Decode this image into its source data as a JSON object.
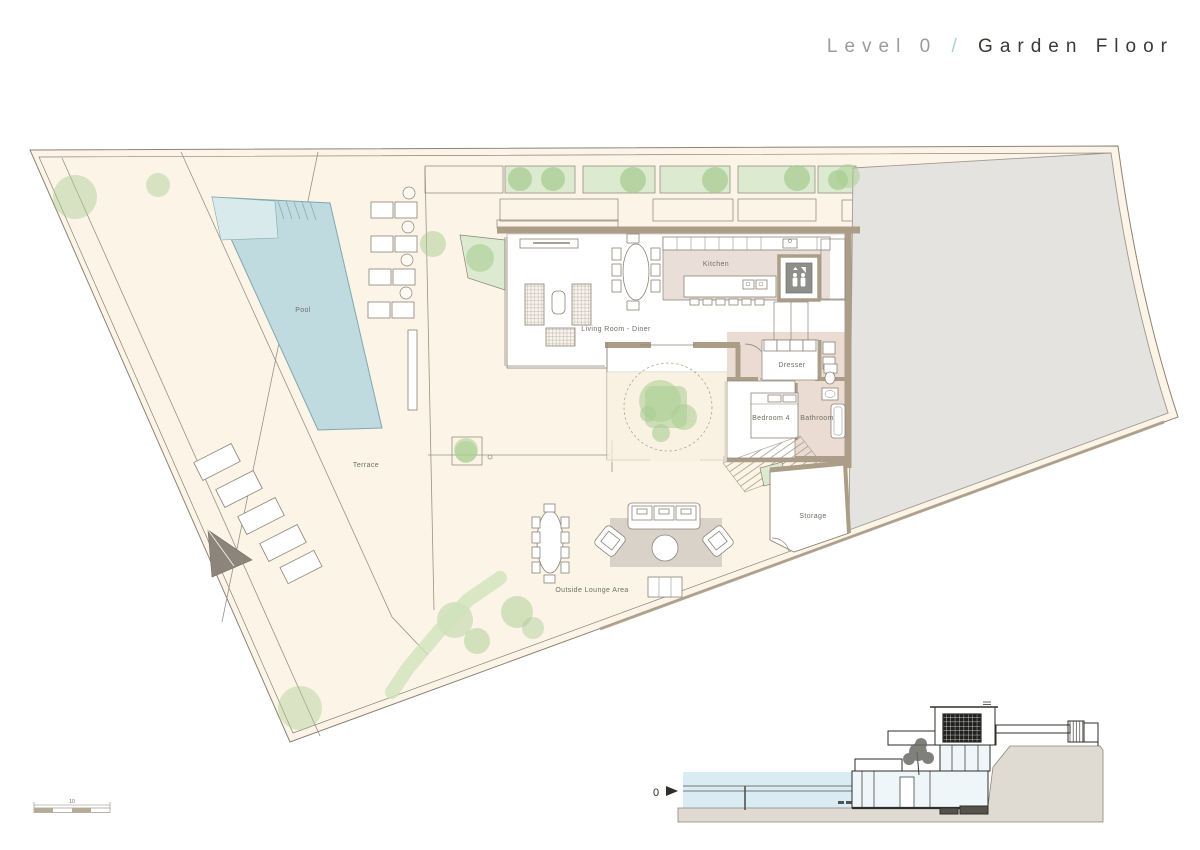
{
  "title": {
    "level": "Level 0",
    "separator": "/",
    "name": "Garden Floor"
  },
  "labels": {
    "pool": "Pool",
    "terrace": "Terrace",
    "living_room": "Living Room - Diner",
    "kitchen": "Kitchen",
    "dresser": "Dresser",
    "bedroom": "Bedroom 4",
    "bathroom": "Bathroom",
    "storage": "Storage",
    "outside_lounge": "Outside Lounge Area"
  },
  "section": {
    "level_marker": "0"
  },
  "scale_bar": {
    "label": "10"
  },
  "icons": {
    "elevator": "elevator-people-icon",
    "section_marker": "level-arrow-icon"
  },
  "colors": {
    "site_fill": "#fbf4e7",
    "terrace_fill": "#f8efe0",
    "wall": "#ac9d89",
    "wall_line": "#8d8378",
    "pool_water": "#c0dbdf",
    "pool_shallow": "#d9eaec",
    "neighbor_gray": "#e4e3e0",
    "planter_green": "#dcead0",
    "tree_green": "#a9cd92",
    "room_white": "#ffffff",
    "kitchen_floor": "#eadfd8",
    "bath_floor": "#eadcd2",
    "rug": "#d9d2c8",
    "section_sky": "#d9ecf3",
    "section_ground": "#e0dbd2",
    "ink": "#2e2e2a",
    "dark_accent": "#55524c",
    "stripe_line": "#c7bcaa",
    "label_text": "#716d64",
    "title_level": "#9b9b97",
    "title_slash": "#a9ced8",
    "title_name": "#3a3a36"
  }
}
